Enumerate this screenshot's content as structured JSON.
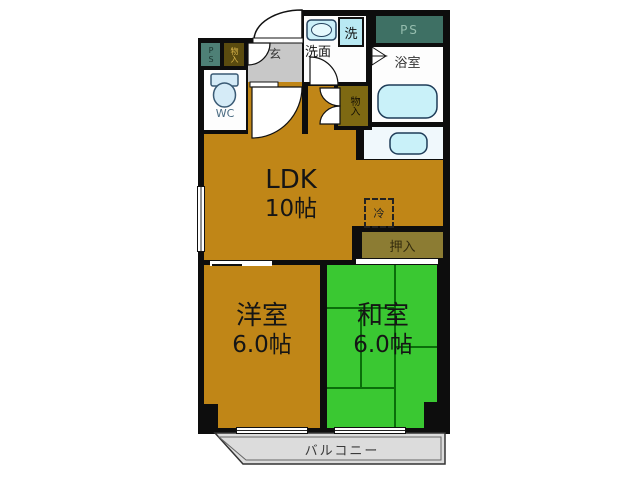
{
  "rooms": {
    "ldk": {
      "name": "LDK",
      "size": "10帖"
    },
    "western": {
      "name": "洋室",
      "size": "6.0帖"
    },
    "japanese": {
      "name": "和室",
      "size": "6.0帖"
    },
    "balcony": {
      "name": "バルコニー"
    },
    "bath": {
      "name": "浴室"
    },
    "washroom": {
      "name": "洗面"
    },
    "wc": {
      "name": "WC"
    },
    "entrance": {
      "name": "玄"
    },
    "oshiire": {
      "name": "押入"
    },
    "storage_hall": {
      "name": "物入"
    },
    "storage_entrance": {
      "name": "物入"
    },
    "ps_left": {
      "name": "PS"
    },
    "ps_right": {
      "name": "PS"
    },
    "washer": {
      "name": "洗"
    },
    "fridge": {
      "name": "冷"
    }
  },
  "colors": {
    "wall": "#0d0d0d",
    "flooring_brown": "#c08617",
    "tatami_green": "#3ac832",
    "tatami_line": "#0a6e0a",
    "closet_olive": "#8c7c33",
    "storage_olive": "#7e6912",
    "ps_teal": "#3e7064",
    "fixture_cyan": "#c9f1f9",
    "entrance_gray": "#c8c8c8",
    "balcony_gray": "#dcdcdc"
  }
}
